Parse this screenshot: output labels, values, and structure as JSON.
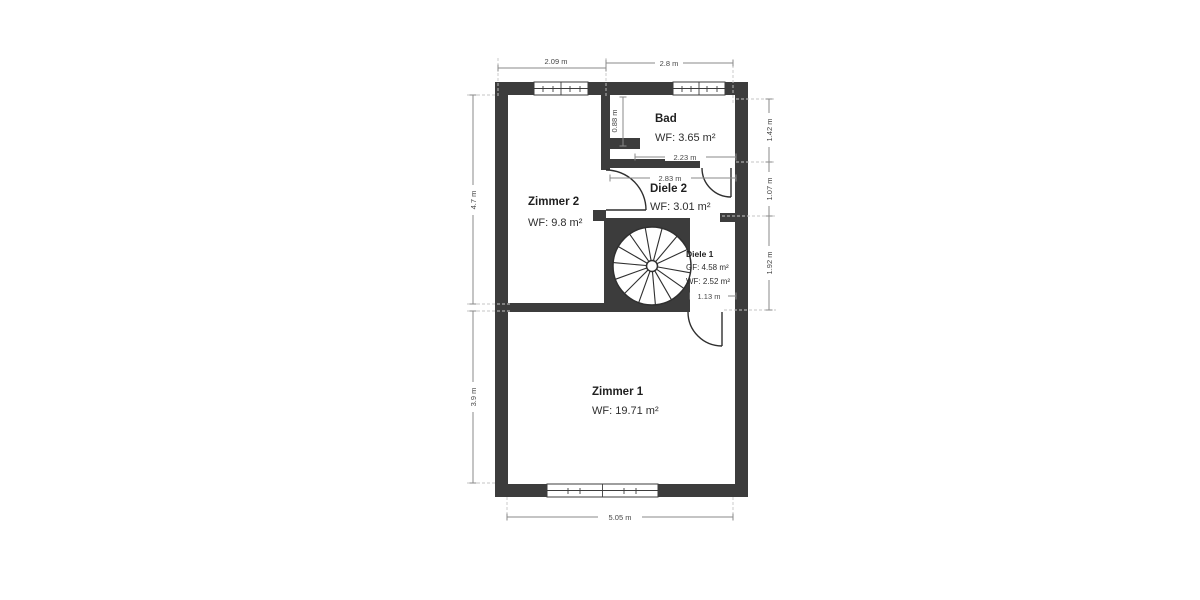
{
  "plan": {
    "rooms": {
      "zimmer2": {
        "name": "Zimmer 2",
        "line1": "WF: 9.8 m²"
      },
      "bad": {
        "name": "Bad",
        "line1": "WF: 3.65 m²"
      },
      "diele2": {
        "name": "Diele 2",
        "line1": "WF: 3.01 m²"
      },
      "diele1": {
        "name": "Diele 1",
        "line1": "GF: 4.58 m²",
        "line2": "WF: 2.52 m²"
      },
      "zimmer1": {
        "name": "Zimmer 1",
        "line1": "WF: 19.71 m²"
      }
    },
    "dimensions": {
      "top": [
        "2.09 m",
        "2.8 m"
      ],
      "left": [
        "4.7 m",
        "3.9 m"
      ],
      "right": [
        "1.42 m",
        "1.07 m",
        "1.92 m"
      ],
      "bottom": [
        "5.05 m"
      ],
      "bad_wall_height": "0.88 m",
      "bad_width": "2.23 m",
      "diele2_width": "2.83 m",
      "corridor_width": "1.13 m"
    },
    "colors": {
      "wall": "#3c3c3c",
      "dimension_line": "#8a8a8a",
      "extension_dash": "#c6c6c6",
      "label_text": "#1f1f1f"
    }
  }
}
